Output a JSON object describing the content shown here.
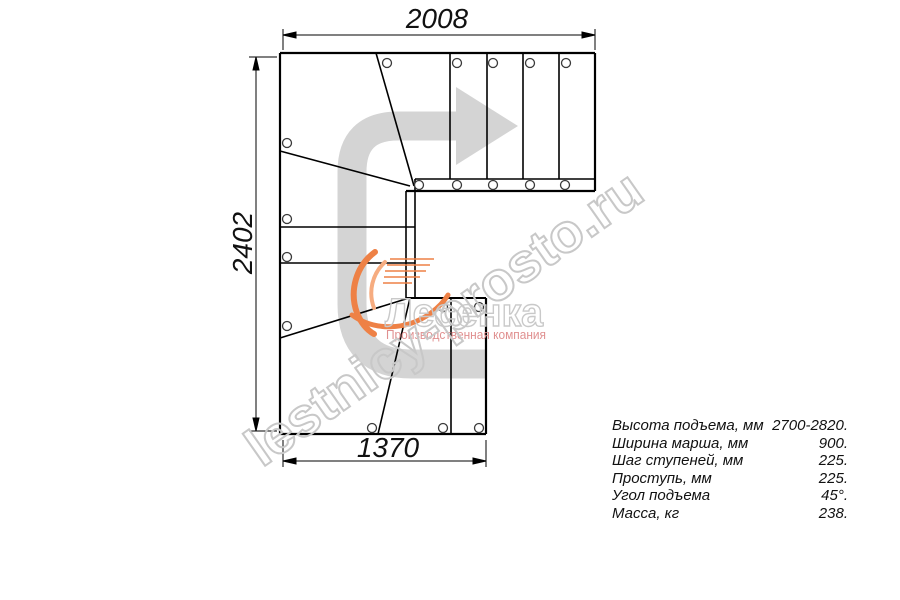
{
  "drawing": {
    "dimensions": {
      "top": "2008",
      "left": "2402",
      "bottom": "1370"
    }
  },
  "watermark": {
    "site_text": "lestnicy-prosto.ru",
    "logo_title": "Лесенка",
    "logo_subtitle": "Производственная компания"
  },
  "specs": {
    "rows": [
      {
        "label": "Высота подъема, мм",
        "value": "2700-2820."
      },
      {
        "label": "Ширина марша, мм",
        "value": "900."
      },
      {
        "label": "Шаг ступеней, мм",
        "value": "225."
      },
      {
        "label": "Проступь, мм",
        "value": "225."
      },
      {
        "label": "Угол подъема",
        "value": "45°."
      },
      {
        "label": "Масса, кг",
        "value": "238."
      }
    ]
  },
  "colors": {
    "line_black": "#000000",
    "arrow_gray": "#d4d4d4",
    "watermark_gray": "#c8c8c8",
    "accent_orange": "#ee8146",
    "logo_inner_orange": "#f6ac80",
    "subtitle_red": "#e09090",
    "dim_text": "#111111"
  }
}
